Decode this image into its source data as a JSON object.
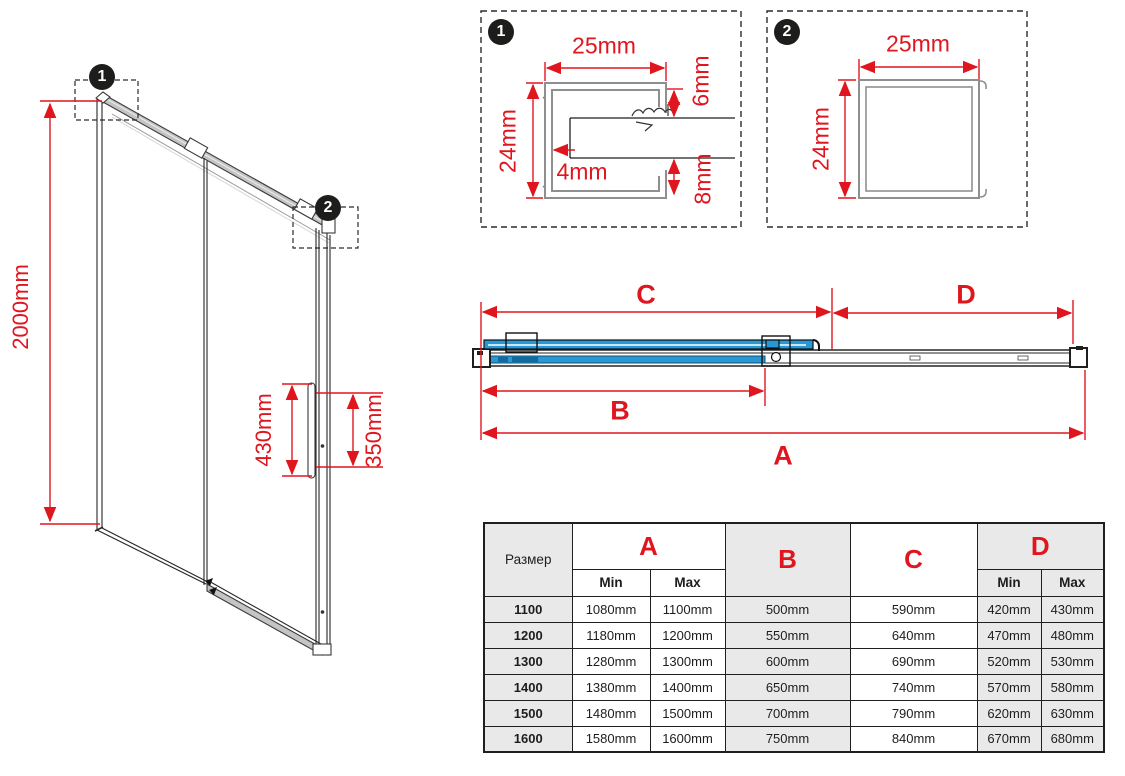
{
  "colors": {
    "red": "#e0161f",
    "blue": "#2598d5",
    "table_gray": "#e9e9e9",
    "line": "#1f1f1f"
  },
  "isometric": {
    "height_label": "2000mm",
    "handle_length_label": "430mm",
    "handle_holes_label": "350mm",
    "callout_1": "1",
    "callout_2": "2"
  },
  "detail_1": {
    "number": "1",
    "width_label": "25mm",
    "height_label": "24mm",
    "glass_gap_label": "4mm",
    "top_gap_label": "6mm",
    "bottom_gap_label": "8mm"
  },
  "detail_2": {
    "number": "2",
    "width_label": "25mm",
    "height_label": "24mm"
  },
  "plan": {
    "dim_a_label": "A",
    "dim_b_label": "B",
    "dim_c_label": "C",
    "dim_d_label": "D"
  },
  "table": {
    "size_header": "Размер",
    "col_a": "A",
    "col_b": "B",
    "col_c": "C",
    "col_d": "D",
    "min_label": "Min",
    "max_label": "Max",
    "rows": [
      {
        "size": "1100",
        "a_min": "1080mm",
        "a_max": "1100mm",
        "b": "500mm",
        "c": "590mm",
        "d_min": "420mm",
        "d_max": "430mm"
      },
      {
        "size": "1200",
        "a_min": "1180mm",
        "a_max": "1200mm",
        "b": "550mm",
        "c": "640mm",
        "d_min": "470mm",
        "d_max": "480mm"
      },
      {
        "size": "1300",
        "a_min": "1280mm",
        "a_max": "1300mm",
        "b": "600mm",
        "c": "690mm",
        "d_min": "520mm",
        "d_max": "530mm"
      },
      {
        "size": "1400",
        "a_min": "1380mm",
        "a_max": "1400mm",
        "b": "650mm",
        "c": "740mm",
        "d_min": "570mm",
        "d_max": "580mm"
      },
      {
        "size": "1500",
        "a_min": "1480mm",
        "a_max": "1500mm",
        "b": "700mm",
        "c": "790mm",
        "d_min": "620mm",
        "d_max": "630mm"
      },
      {
        "size": "1600",
        "a_min": "1580mm",
        "a_max": "1600mm",
        "b": "750mm",
        "c": "840mm",
        "d_min": "670mm",
        "d_max": "680mm"
      }
    ]
  }
}
